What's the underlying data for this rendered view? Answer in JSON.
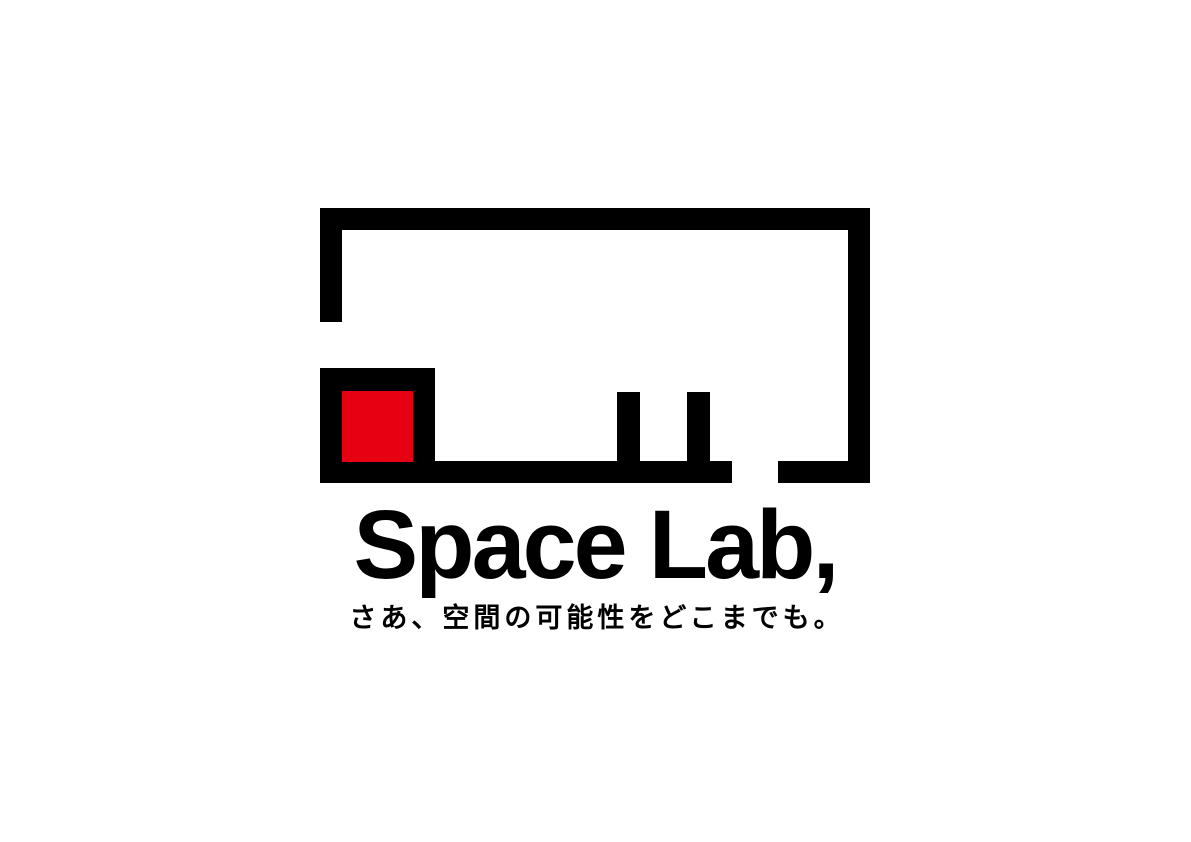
{
  "brand": {
    "wordmark": "Space Lab,",
    "tagline": "さあ、空間の可能性をどこまでも。"
  },
  "mark": {
    "description": "abstract-room-outline-with-red-square",
    "segments": [
      "frame-top-edge",
      "frame-right-edge",
      "frame-left-edge-upper",
      "room-box-lower-left",
      "red-square",
      "floor-edge-main",
      "floor-edge-right",
      "pillar-left",
      "pillar-right"
    ]
  },
  "colors": {
    "ink": "#000000",
    "accent_red": "#e60012",
    "background": "#ffffff"
  }
}
